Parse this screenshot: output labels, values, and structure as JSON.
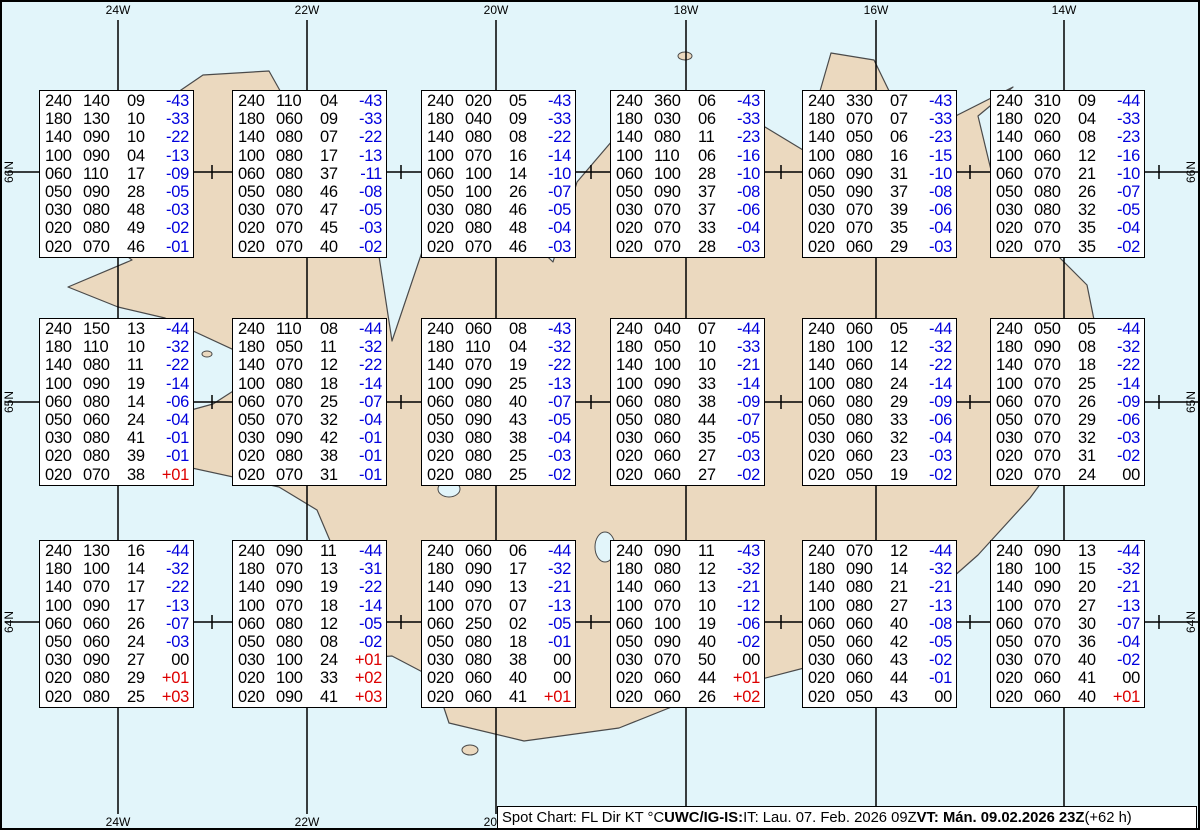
{
  "map": {
    "sea_color": "#e2f5fa",
    "land_color": "#ebd9bf",
    "coast_color": "#4a4a4a",
    "grid_color": "#000000",
    "top_labels": [
      "24W",
      "22W",
      "20W",
      "18W",
      "16W",
      "14W"
    ],
    "bottom_labels": [
      "24W",
      "22W",
      "20W"
    ],
    "left_labels": [
      "66N",
      "65N",
      "64N"
    ],
    "right_labels": [
      "66N",
      "65N",
      "64N"
    ]
  },
  "colors": {
    "negative_temp": "#0000dd",
    "positive_temp": "#dd0000",
    "zero_temp": "#000000"
  },
  "footer": {
    "part1": "Spot Chart: FL Dir KT °C ",
    "part2_bold": "UWC/IG-IS:",
    "part3": " IT: Lau. 07. Feb. 2026 09Z ",
    "part4_bold": "VT: Mán. 09.02.2026 23Z",
    "part5": " (+62 h)"
  },
  "chart_data": {
    "type": "table",
    "title": "Spot Chart: FL Dir KT °C",
    "columns": [
      "FL",
      "Dir",
      "KT",
      "°C"
    ],
    "meridians": [
      "24W",
      "22W",
      "20W",
      "18W",
      "16W",
      "14W"
    ],
    "parallels": [
      "66N",
      "65N",
      "64N"
    ],
    "boxes": [
      {
        "row": 0,
        "col": 0,
        "levels": [
          [
            "240",
            "140",
            "09",
            "-43"
          ],
          [
            "180",
            "130",
            "10",
            "-33"
          ],
          [
            "140",
            "090",
            "10",
            "-22"
          ],
          [
            "100",
            "090",
            "04",
            "-13"
          ],
          [
            "060",
            "110",
            "17",
            "-09"
          ],
          [
            "050",
            "090",
            "28",
            "-05"
          ],
          [
            "030",
            "080",
            "48",
            "-03"
          ],
          [
            "020",
            "080",
            "49",
            "-02"
          ],
          [
            "020",
            "070",
            "46",
            "-01"
          ]
        ]
      },
      {
        "row": 0,
        "col": 1,
        "levels": [
          [
            "240",
            "110",
            "04",
            "-43"
          ],
          [
            "180",
            "060",
            "09",
            "-33"
          ],
          [
            "140",
            "080",
            "07",
            "-22"
          ],
          [
            "100",
            "080",
            "17",
            "-13"
          ],
          [
            "060",
            "080",
            "37",
            "-11"
          ],
          [
            "050",
            "080",
            "46",
            "-08"
          ],
          [
            "030",
            "070",
            "47",
            "-05"
          ],
          [
            "020",
            "070",
            "45",
            "-03"
          ],
          [
            "020",
            "070",
            "40",
            "-02"
          ]
        ]
      },
      {
        "row": 0,
        "col": 2,
        "levels": [
          [
            "240",
            "020",
            "05",
            "-43"
          ],
          [
            "180",
            "040",
            "09",
            "-33"
          ],
          [
            "140",
            "080",
            "08",
            "-22"
          ],
          [
            "100",
            "070",
            "16",
            "-14"
          ],
          [
            "060",
            "100",
            "14",
            "-10"
          ],
          [
            "050",
            "100",
            "26",
            "-07"
          ],
          [
            "030",
            "080",
            "46",
            "-05"
          ],
          [
            "020",
            "080",
            "48",
            "-04"
          ],
          [
            "020",
            "070",
            "46",
            "-03"
          ]
        ]
      },
      {
        "row": 0,
        "col": 3,
        "levels": [
          [
            "240",
            "360",
            "06",
            "-43"
          ],
          [
            "180",
            "030",
            "06",
            "-33"
          ],
          [
            "140",
            "080",
            "11",
            "-23"
          ],
          [
            "100",
            "110",
            "06",
            "-16"
          ],
          [
            "060",
            "100",
            "28",
            "-10"
          ],
          [
            "050",
            "090",
            "37",
            "-08"
          ],
          [
            "030",
            "070",
            "37",
            "-06"
          ],
          [
            "020",
            "070",
            "33",
            "-04"
          ],
          [
            "020",
            "070",
            "28",
            "-03"
          ]
        ]
      },
      {
        "row": 0,
        "col": 4,
        "levels": [
          [
            "240",
            "330",
            "07",
            "-43"
          ],
          [
            "180",
            "070",
            "07",
            "-33"
          ],
          [
            "140",
            "050",
            "06",
            "-23"
          ],
          [
            "100",
            "080",
            "16",
            "-15"
          ],
          [
            "060",
            "090",
            "31",
            "-10"
          ],
          [
            "050",
            "090",
            "37",
            "-08"
          ],
          [
            "030",
            "070",
            "39",
            "-06"
          ],
          [
            "020",
            "070",
            "35",
            "-04"
          ],
          [
            "020",
            "060",
            "29",
            "-03"
          ]
        ]
      },
      {
        "row": 0,
        "col": 5,
        "levels": [
          [
            "240",
            "310",
            "09",
            "-44"
          ],
          [
            "180",
            "020",
            "04",
            "-33"
          ],
          [
            "140",
            "060",
            "08",
            "-23"
          ],
          [
            "100",
            "060",
            "12",
            "-16"
          ],
          [
            "060",
            "070",
            "21",
            "-10"
          ],
          [
            "050",
            "080",
            "26",
            "-07"
          ],
          [
            "030",
            "080",
            "32",
            "-05"
          ],
          [
            "020",
            "070",
            "35",
            "-04"
          ],
          [
            "020",
            "070",
            "35",
            "-02"
          ]
        ]
      },
      {
        "row": 1,
        "col": 0,
        "levels": [
          [
            "240",
            "150",
            "13",
            "-44"
          ],
          [
            "180",
            "110",
            "10",
            "-32"
          ],
          [
            "140",
            "080",
            "11",
            "-22"
          ],
          [
            "100",
            "090",
            "19",
            "-14"
          ],
          [
            "060",
            "080",
            "14",
            "-06"
          ],
          [
            "050",
            "060",
            "24",
            "-04"
          ],
          [
            "030",
            "080",
            "41",
            "-01"
          ],
          [
            "020",
            "080",
            "39",
            "-01"
          ],
          [
            "020",
            "070",
            "38",
            "+01"
          ]
        ]
      },
      {
        "row": 1,
        "col": 1,
        "levels": [
          [
            "240",
            "110",
            "08",
            "-44"
          ],
          [
            "180",
            "050",
            "11",
            "-32"
          ],
          [
            "140",
            "070",
            "12",
            "-22"
          ],
          [
            "100",
            "080",
            "18",
            "-14"
          ],
          [
            "060",
            "070",
            "25",
            "-07"
          ],
          [
            "050",
            "070",
            "32",
            "-04"
          ],
          [
            "030",
            "090",
            "42",
            "-01"
          ],
          [
            "020",
            "080",
            "38",
            "-01"
          ],
          [
            "020",
            "070",
            "31",
            "-01"
          ]
        ]
      },
      {
        "row": 1,
        "col": 2,
        "levels": [
          [
            "240",
            "060",
            "08",
            "-43"
          ],
          [
            "180",
            "110",
            "04",
            "-32"
          ],
          [
            "140",
            "070",
            "19",
            "-22"
          ],
          [
            "100",
            "090",
            "25",
            "-13"
          ],
          [
            "060",
            "080",
            "40",
            "-07"
          ],
          [
            "050",
            "090",
            "43",
            "-05"
          ],
          [
            "030",
            "080",
            "38",
            "-04"
          ],
          [
            "020",
            "080",
            "25",
            "-03"
          ],
          [
            "020",
            "080",
            "25",
            "-02"
          ]
        ]
      },
      {
        "row": 1,
        "col": 3,
        "levels": [
          [
            "240",
            "040",
            "07",
            "-44"
          ],
          [
            "180",
            "050",
            "10",
            "-33"
          ],
          [
            "140",
            "100",
            "10",
            "-21"
          ],
          [
            "100",
            "090",
            "33",
            "-14"
          ],
          [
            "060",
            "080",
            "38",
            "-09"
          ],
          [
            "050",
            "080",
            "44",
            "-07"
          ],
          [
            "030",
            "060",
            "35",
            "-05"
          ],
          [
            "020",
            "060",
            "27",
            "-03"
          ],
          [
            "020",
            "060",
            "27",
            "-02"
          ]
        ]
      },
      {
        "row": 1,
        "col": 4,
        "levels": [
          [
            "240",
            "060",
            "05",
            "-44"
          ],
          [
            "180",
            "100",
            "12",
            "-32"
          ],
          [
            "140",
            "060",
            "14",
            "-22"
          ],
          [
            "100",
            "080",
            "24",
            "-14"
          ],
          [
            "060",
            "080",
            "29",
            "-09"
          ],
          [
            "050",
            "080",
            "33",
            "-06"
          ],
          [
            "030",
            "060",
            "32",
            "-04"
          ],
          [
            "020",
            "060",
            "23",
            "-03"
          ],
          [
            "020",
            "050",
            "19",
            "-02"
          ]
        ]
      },
      {
        "row": 1,
        "col": 5,
        "levels": [
          [
            "240",
            "050",
            "05",
            "-44"
          ],
          [
            "180",
            "090",
            "08",
            "-32"
          ],
          [
            "140",
            "070",
            "18",
            "-22"
          ],
          [
            "100",
            "070",
            "25",
            "-14"
          ],
          [
            "060",
            "070",
            "26",
            "-09"
          ],
          [
            "050",
            "070",
            "29",
            "-06"
          ],
          [
            "030",
            "070",
            "32",
            "-03"
          ],
          [
            "020",
            "070",
            "31",
            "-02"
          ],
          [
            "020",
            "070",
            "24",
            "00"
          ]
        ]
      },
      {
        "row": 2,
        "col": 0,
        "levels": [
          [
            "240",
            "130",
            "16",
            "-44"
          ],
          [
            "180",
            "100",
            "14",
            "-32"
          ],
          [
            "140",
            "070",
            "17",
            "-22"
          ],
          [
            "100",
            "090",
            "17",
            "-13"
          ],
          [
            "060",
            "060",
            "26",
            "-07"
          ],
          [
            "050",
            "060",
            "24",
            "-03"
          ],
          [
            "030",
            "090",
            "27",
            "00"
          ],
          [
            "020",
            "080",
            "29",
            "+01"
          ],
          [
            "020",
            "080",
            "25",
            "+03"
          ]
        ]
      },
      {
        "row": 2,
        "col": 1,
        "levels": [
          [
            "240",
            "090",
            "11",
            "-44"
          ],
          [
            "180",
            "070",
            "13",
            "-31"
          ],
          [
            "140",
            "090",
            "19",
            "-22"
          ],
          [
            "100",
            "070",
            "18",
            "-14"
          ],
          [
            "060",
            "080",
            "12",
            "-05"
          ],
          [
            "050",
            "080",
            "08",
            "-02"
          ],
          [
            "030",
            "100",
            "24",
            "+01"
          ],
          [
            "020",
            "100",
            "33",
            "+02"
          ],
          [
            "020",
            "090",
            "41",
            "+03"
          ]
        ]
      },
      {
        "row": 2,
        "col": 2,
        "levels": [
          [
            "240",
            "060",
            "06",
            "-44"
          ],
          [
            "180",
            "090",
            "17",
            "-32"
          ],
          [
            "140",
            "090",
            "13",
            "-21"
          ],
          [
            "100",
            "070",
            "07",
            "-13"
          ],
          [
            "060",
            "250",
            "02",
            "-05"
          ],
          [
            "050",
            "080",
            "18",
            "-01"
          ],
          [
            "030",
            "080",
            "38",
            "00"
          ],
          [
            "020",
            "060",
            "40",
            "00"
          ],
          [
            "020",
            "060",
            "41",
            "+01"
          ]
        ]
      },
      {
        "row": 2,
        "col": 3,
        "levels": [
          [
            "240",
            "090",
            "11",
            "-43"
          ],
          [
            "180",
            "080",
            "12",
            "-32"
          ],
          [
            "140",
            "060",
            "13",
            "-21"
          ],
          [
            "100",
            "070",
            "10",
            "-12"
          ],
          [
            "060",
            "100",
            "19",
            "-06"
          ],
          [
            "050",
            "090",
            "40",
            "-02"
          ],
          [
            "030",
            "070",
            "50",
            "00"
          ],
          [
            "020",
            "060",
            "44",
            "+01"
          ],
          [
            "020",
            "060",
            "26",
            "+02"
          ]
        ]
      },
      {
        "row": 2,
        "col": 4,
        "levels": [
          [
            "240",
            "070",
            "12",
            "-44"
          ],
          [
            "180",
            "090",
            "14",
            "-32"
          ],
          [
            "140",
            "080",
            "21",
            "-21"
          ],
          [
            "100",
            "080",
            "27",
            "-13"
          ],
          [
            "060",
            "060",
            "40",
            "-08"
          ],
          [
            "050",
            "060",
            "42",
            "-05"
          ],
          [
            "030",
            "060",
            "43",
            "-02"
          ],
          [
            "020",
            "060",
            "44",
            "-01"
          ],
          [
            "020",
            "050",
            "43",
            "00"
          ]
        ]
      },
      {
        "row": 2,
        "col": 5,
        "levels": [
          [
            "240",
            "090",
            "13",
            "-44"
          ],
          [
            "180",
            "100",
            "15",
            "-32"
          ],
          [
            "140",
            "090",
            "20",
            "-21"
          ],
          [
            "100",
            "070",
            "27",
            "-13"
          ],
          [
            "060",
            "070",
            "30",
            "-07"
          ],
          [
            "050",
            "070",
            "36",
            "-04"
          ],
          [
            "030",
            "070",
            "40",
            "-02"
          ],
          [
            "020",
            "060",
            "41",
            "00"
          ],
          [
            "020",
            "060",
            "40",
            "+01"
          ]
        ]
      }
    ]
  }
}
